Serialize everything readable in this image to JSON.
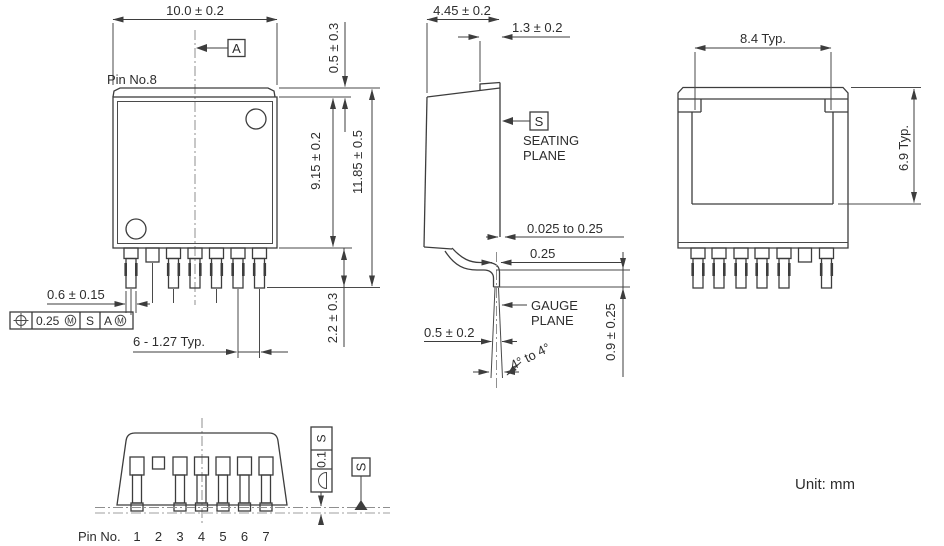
{
  "drawing": {
    "unit_label": "Unit: mm",
    "front_view": {
      "pin8_label": "Pin No.8",
      "datum_a_label": "A",
      "dim_body_width": "10.0 ± 0.2",
      "dim_tab_exposed": "0.5 ± 0.3",
      "dim_body_height": "9.15 ± 0.2",
      "dim_overall_height": "11.85 ± 0.5",
      "dim_lead_protrusion": "2.2 ± 0.3",
      "dim_lead_width": "0.6 ± 0.15",
      "dim_lead_pitch": "6 - 1.27 Typ.",
      "position_tolerance": {
        "value": "0.25",
        "modifier": "M",
        "primary_datum": "S",
        "secondary_datum": "A",
        "secondary_modifier": "M"
      }
    },
    "side_view": {
      "dim_body_depth": "4.45 ± 0.2",
      "dim_tab_depth": "1.3 ± 0.2",
      "seating_datum_label": "S",
      "seating_plane_word1": "SEATING",
      "seating_plane_word2": "PLANE",
      "dim_standoff": "0.025 to 0.25",
      "dim_lead_thickness": "0.25",
      "gauge_plane_word1": "GAUGE",
      "gauge_plane_word2": "PLANE",
      "dim_foot_width": "0.5 ± 0.2",
      "dim_gauge_height": "0.9 ± 0.25",
      "dim_lead_angle": "4° to 4°"
    },
    "back_view": {
      "dim_tab_width": "8.4 Typ.",
      "dim_tab_height": "6.9 Typ."
    },
    "bottom_view": {
      "flatness_tolerance": {
        "value": "0.1",
        "datum": "S"
      },
      "seating_datum_label": "S",
      "pin_row_label": "Pin No.",
      "pin_numbers": [
        "1",
        "2",
        "3",
        "4",
        "5",
        "6",
        "7"
      ]
    }
  }
}
